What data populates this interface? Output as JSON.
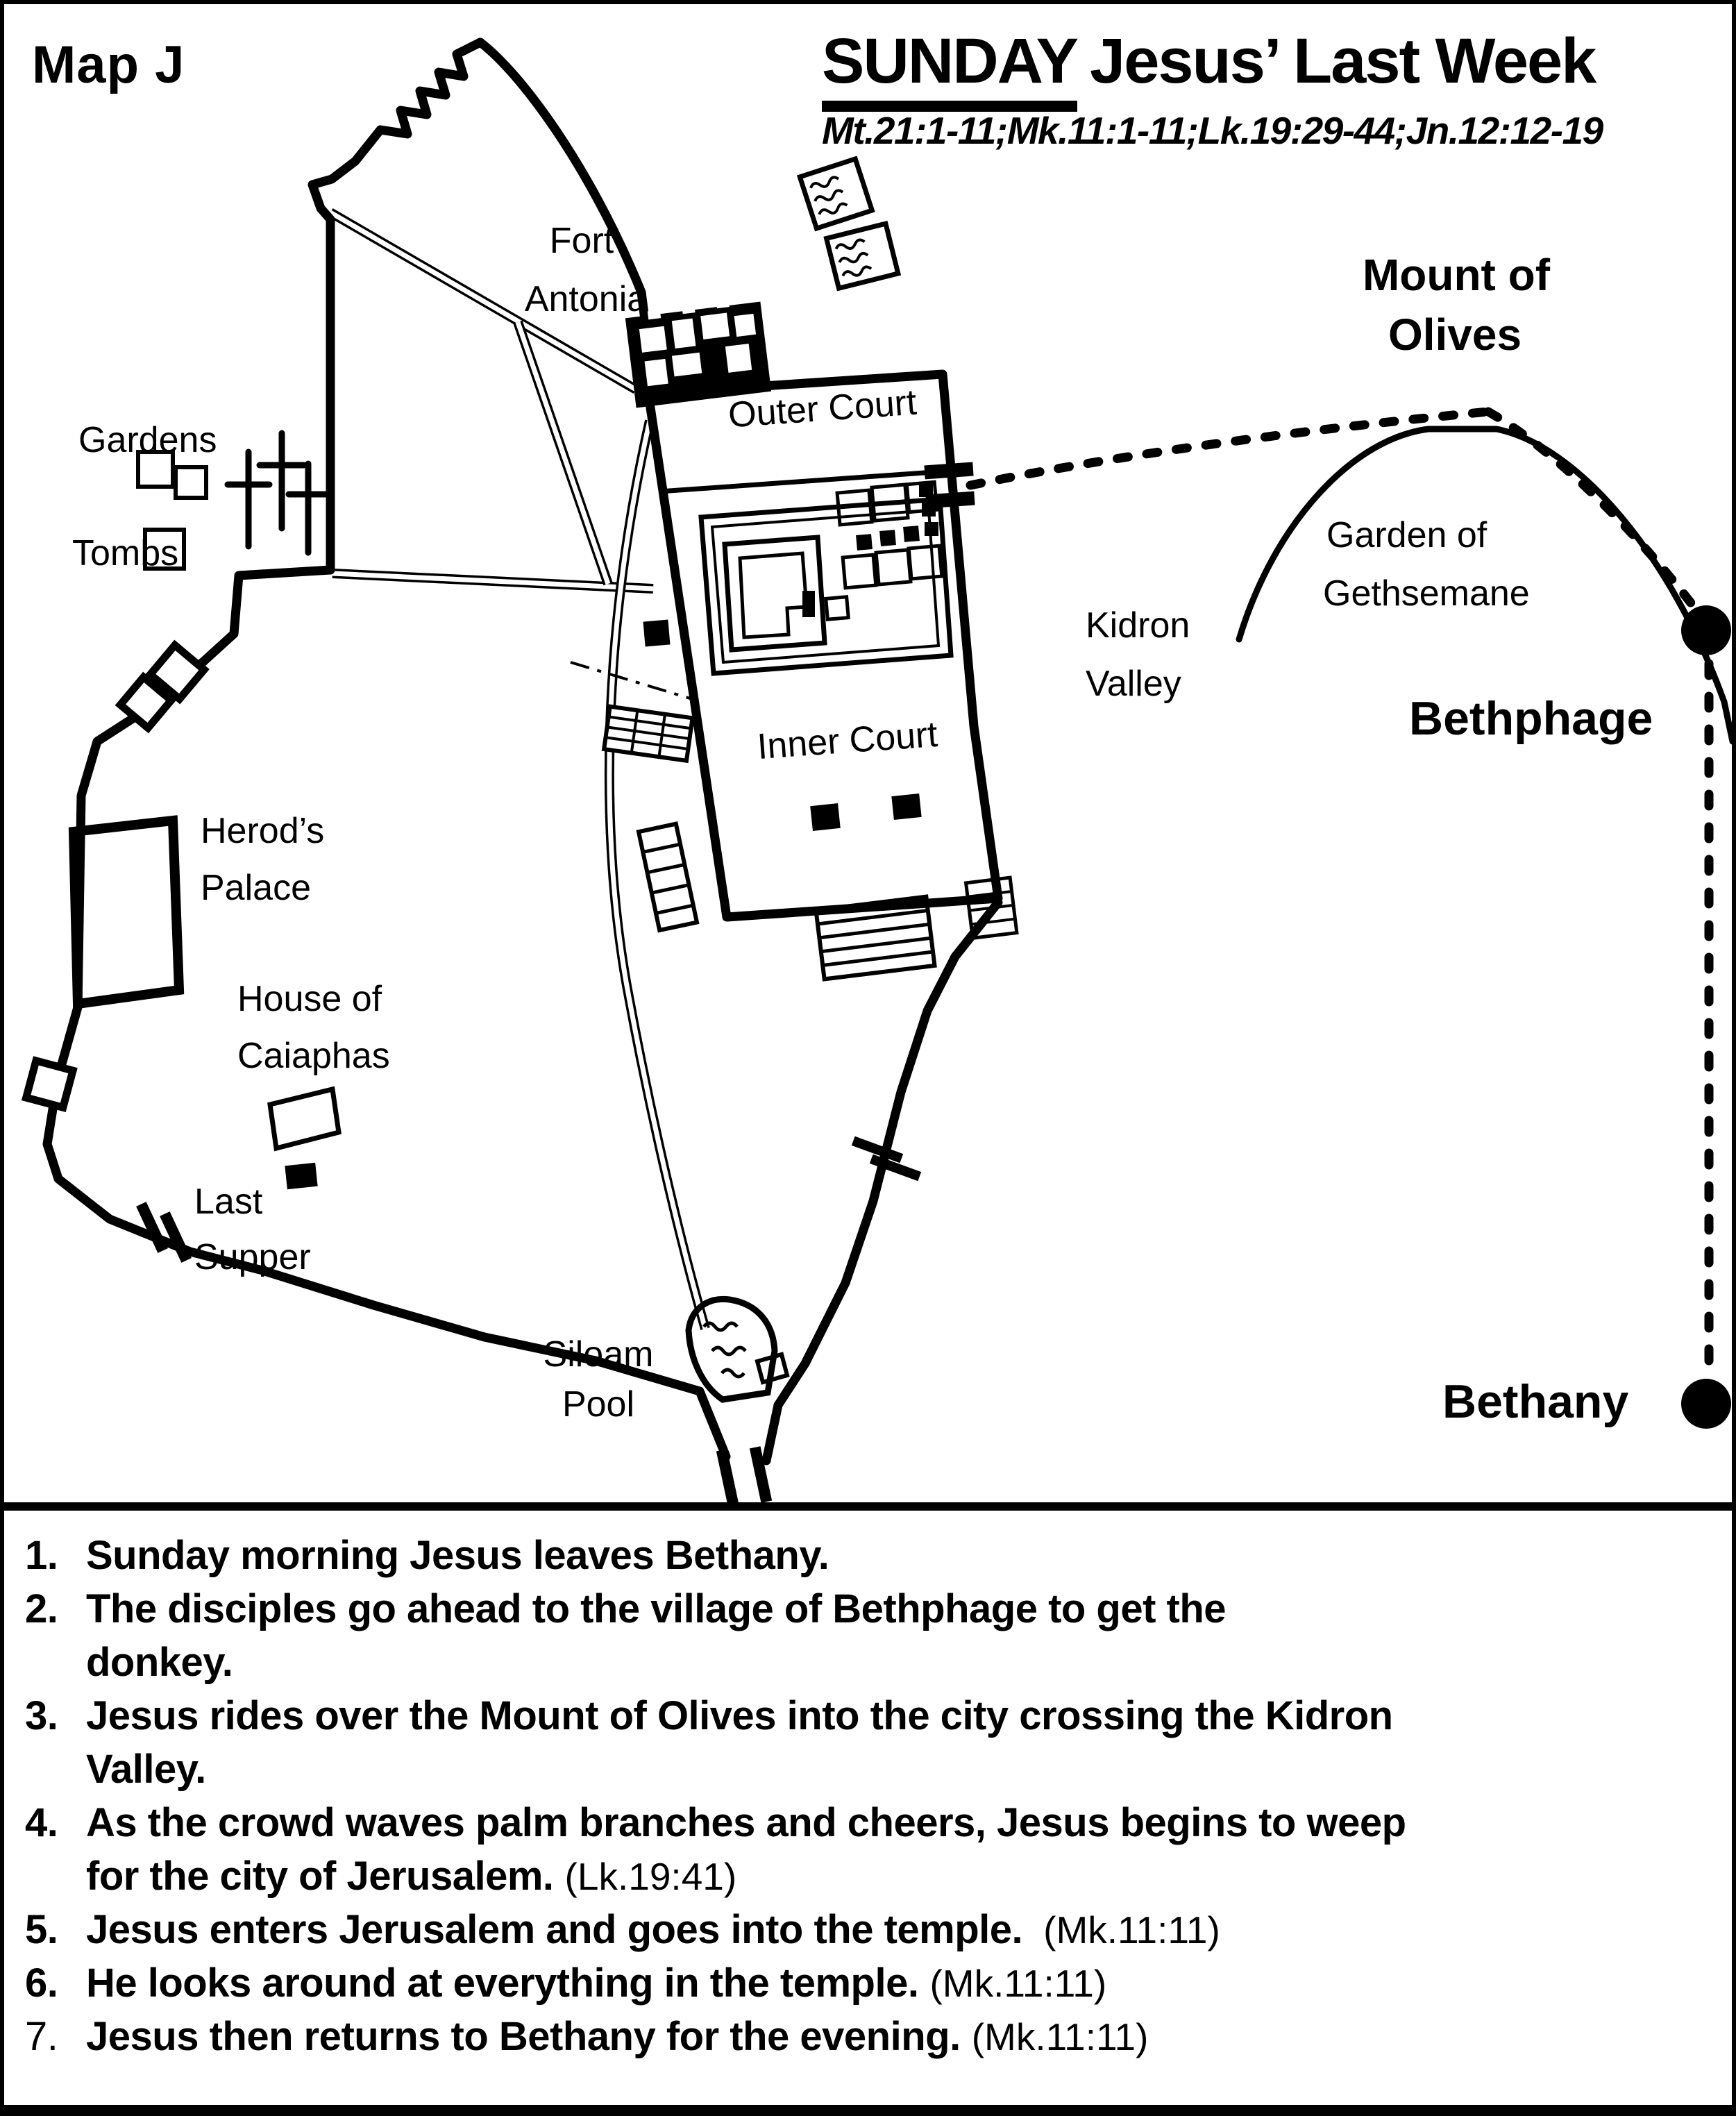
{
  "page": {
    "map_label": "Map J"
  },
  "title": {
    "day": "SUNDAY",
    "rest": "Jesus’ Last Week",
    "refs": "Mt.21:1-11;Mk.11:1-11;Lk.19:29-44;Jn.12:12-19"
  },
  "map": {
    "labels": {
      "fort_antonia": {
        "l1": "Fort",
        "l2": "Antonia"
      },
      "outer_court": "Outer Court",
      "inner_court": "Inner Court",
      "gardens": "Gardens",
      "tombs": "Tombs",
      "herods_palace": {
        "l1": "Herod’s",
        "l2": "Palace"
      },
      "house_of_caiaphas": {
        "l1": "House of",
        "l2": "Caiaphas"
      },
      "last_supper": {
        "l1": "Last",
        "l2": "Supper"
      },
      "siloam_pool": {
        "l1": "Siloam",
        "l2": "Pool"
      },
      "kidron_valley": {
        "l1": "Kidron",
        "l2": "Valley"
      },
      "garden_of_gethsemane": {
        "l1": "Garden of",
        "l2": "Gethsemane"
      },
      "mount_of_olives": {
        "l1": "Mount of",
        "l2": "Olives"
      },
      "bethphage": "Bethphage",
      "bethany": "Bethany"
    }
  },
  "events": [
    {
      "num": "1.",
      "line1": "Sunday morning Jesus leaves Bethany.",
      "line2": "",
      "ref": ""
    },
    {
      "num": "2.",
      "line1": "The disciples go ahead to the village of Bethphage to get the",
      "line2": "donkey.",
      "ref": ""
    },
    {
      "num": "3.",
      "line1": "Jesus rides over the Mount of Olives into the city crossing the Kidron",
      "line2": "Valley.",
      "ref": ""
    },
    {
      "num": "4.",
      "line1": "As the crowd waves palm branches and cheers, Jesus begins to weep",
      "line2": "for the city of Jerusalem.",
      "ref": "(Lk.19:41)"
    },
    {
      "num": "5.",
      "line1": "Jesus enters Jerusalem and goes into the temple.",
      "line2": "",
      "ref": "(Mk.11:11)"
    },
    {
      "num": "6.",
      "line1": "He looks around at everything in the temple.",
      "line2": "",
      "ref": "(Mk.11:11)"
    },
    {
      "num": "7.",
      "line1": "Jesus then returns to Bethany for the evening.",
      "line2": "",
      "ref": "(Mk.11:11)"
    }
  ],
  "colors": {
    "ink": "#000000",
    "paper": "#ffffff"
  }
}
